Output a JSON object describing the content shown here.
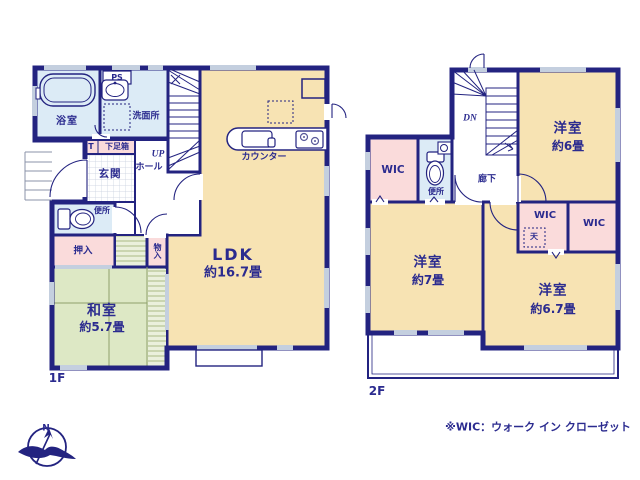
{
  "colors": {
    "wall": "#232380",
    "text": "#2b2b8f",
    "room_tan": "#f7e3b3",
    "tatami_green": "#dde8c5",
    "closet_pink": "#fadbdb",
    "wet_blue": "#dcebf6",
    "window_gray": "#c4cfdf"
  },
  "floor1": {
    "floor_label": "1F",
    "labels": {
      "bathroom": "浴室",
      "ps": "PS",
      "washroom": "洗面所",
      "shoe_t": "T",
      "shoe_box": "下足箱",
      "entrance": "玄関",
      "hall": "ホール",
      "up": "UP",
      "toilet": "便所",
      "oshiire": "押入",
      "storage": "物入",
      "washitsu": "和室",
      "washitsu_size": "約5.7畳",
      "ldk": "LDK",
      "ldk_size": "約16.7畳",
      "counter": "カウンター"
    }
  },
  "floor2": {
    "floor_label": "2F",
    "labels": {
      "dn": "DN",
      "hall": "廊下",
      "wic1": "WIC",
      "toilet": "便所",
      "room6": "洋室",
      "room6_size": "約6畳",
      "room7": "洋室",
      "room7_size": "約7畳",
      "room67": "洋室",
      "room67_size": "約6.7畳",
      "wic2": "WIC",
      "ceiling_hatch": "天",
      "wic3": "WIC"
    }
  },
  "compass": {
    "north": "N"
  },
  "footnote": "※WIC：ウォーク イン クローゼット"
}
